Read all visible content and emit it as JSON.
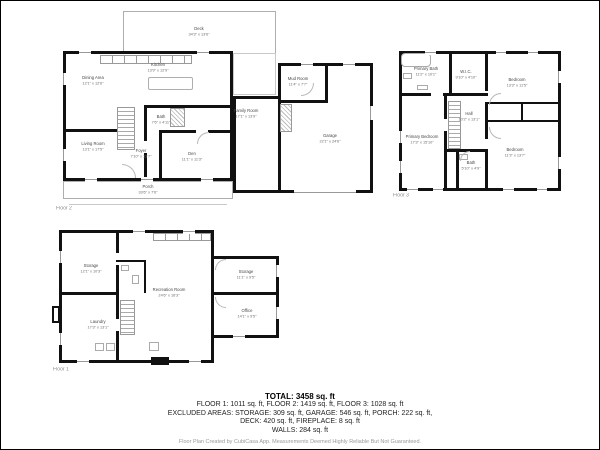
{
  "colors": {
    "walls": "#111111",
    "thin_lines": "#aeaeae",
    "label_text": "#474747",
    "summary_text": "#222222",
    "disclaimer_text": "#9a9a9a"
  },
  "plans": {
    "floor2": {
      "label": "Floor 2",
      "rooms": {
        "deck": {
          "name": "Deck",
          "dims": "34'3\" x 13'6\""
        },
        "dining": {
          "name": "Dining Area",
          "dims": "12'1\" x 12'6\""
        },
        "kitchen": {
          "name": "Kitchen",
          "dims": "13'9\" x 12'9\""
        },
        "living": {
          "name": "Living Room",
          "dims": "13'1\" x 17'5\""
        },
        "bath": {
          "name": "Bath",
          "dims": "7'6\" x 4'11\""
        },
        "foyer": {
          "name": "Foyer",
          "dims": "7'10\" x 13'7\""
        },
        "den": {
          "name": "Den",
          "dims": "11'1\" x 11'3\""
        },
        "porch": {
          "name": "Porch",
          "dims": "33'6\" x 7'6\""
        },
        "family": {
          "name": "Family Room",
          "dims": "17'1\" x 13'9\""
        },
        "mud": {
          "name": "Mud Room",
          "dims": "11'4\" x 7'7\""
        },
        "garage": {
          "name": "Garage",
          "dims": "22'1\" x 24'6\""
        }
      }
    },
    "floor3": {
      "label": "Floor 3",
      "rooms": {
        "primary_bath": {
          "name": "Primary Bath",
          "dims": "11'2\" x 10'1\""
        },
        "wic": {
          "name": "W.I.C.",
          "dims": "9'10\" x 4'10\""
        },
        "bedroom1": {
          "name": "Bedroom",
          "dims": "13'3\" x 11'5\""
        },
        "hall": {
          "name": "Hall",
          "dims": "10'2\" x 13'1\""
        },
        "primary_bedroom": {
          "name": "Primary Bedroom",
          "dims": "17'3\" x 15'10\""
        },
        "bath": {
          "name": "Bath",
          "dims": "5'10\" x 4'9\""
        },
        "bedroom2": {
          "name": "Bedroom",
          "dims": "11'3\" x 13'7\""
        }
      }
    },
    "floor1": {
      "label": "Floor 1",
      "rooms": {
        "storage1": {
          "name": "Storage",
          "dims": "12'1\" x 10'3\""
        },
        "recreation": {
          "name": "Recreation Room",
          "dims": "24'6\" x 16'3\""
        },
        "storage2": {
          "name": "Storage",
          "dims": "11'1\" x 9'5\""
        },
        "office": {
          "name": "Office",
          "dims": "14'1\" x 9'5\""
        },
        "laundry": {
          "name": "Laundry",
          "dims": "17'3\" x 13'1\""
        }
      }
    }
  },
  "summary": {
    "total": "TOTAL: 3458 sq. ft",
    "floors": "FLOOR 1: 1011 sq. ft, FLOOR 2: 1419 sq. ft, FLOOR 3: 1028 sq. ft",
    "excluded1": "EXCLUDED AREAS: STORAGE: 309 sq. ft, GARAGE: 546 sq. ft, PORCH: 222 sq. ft,",
    "excluded2": "DECK: 420 sq. ft, FIREPLACE: 8 sq. ft",
    "walls": "WALLS: 284 sq. ft",
    "disclaimer": "Floor Plan Created by CubiCasa App. Measurements Deemed Highly Reliable But Not Guaranteed."
  }
}
